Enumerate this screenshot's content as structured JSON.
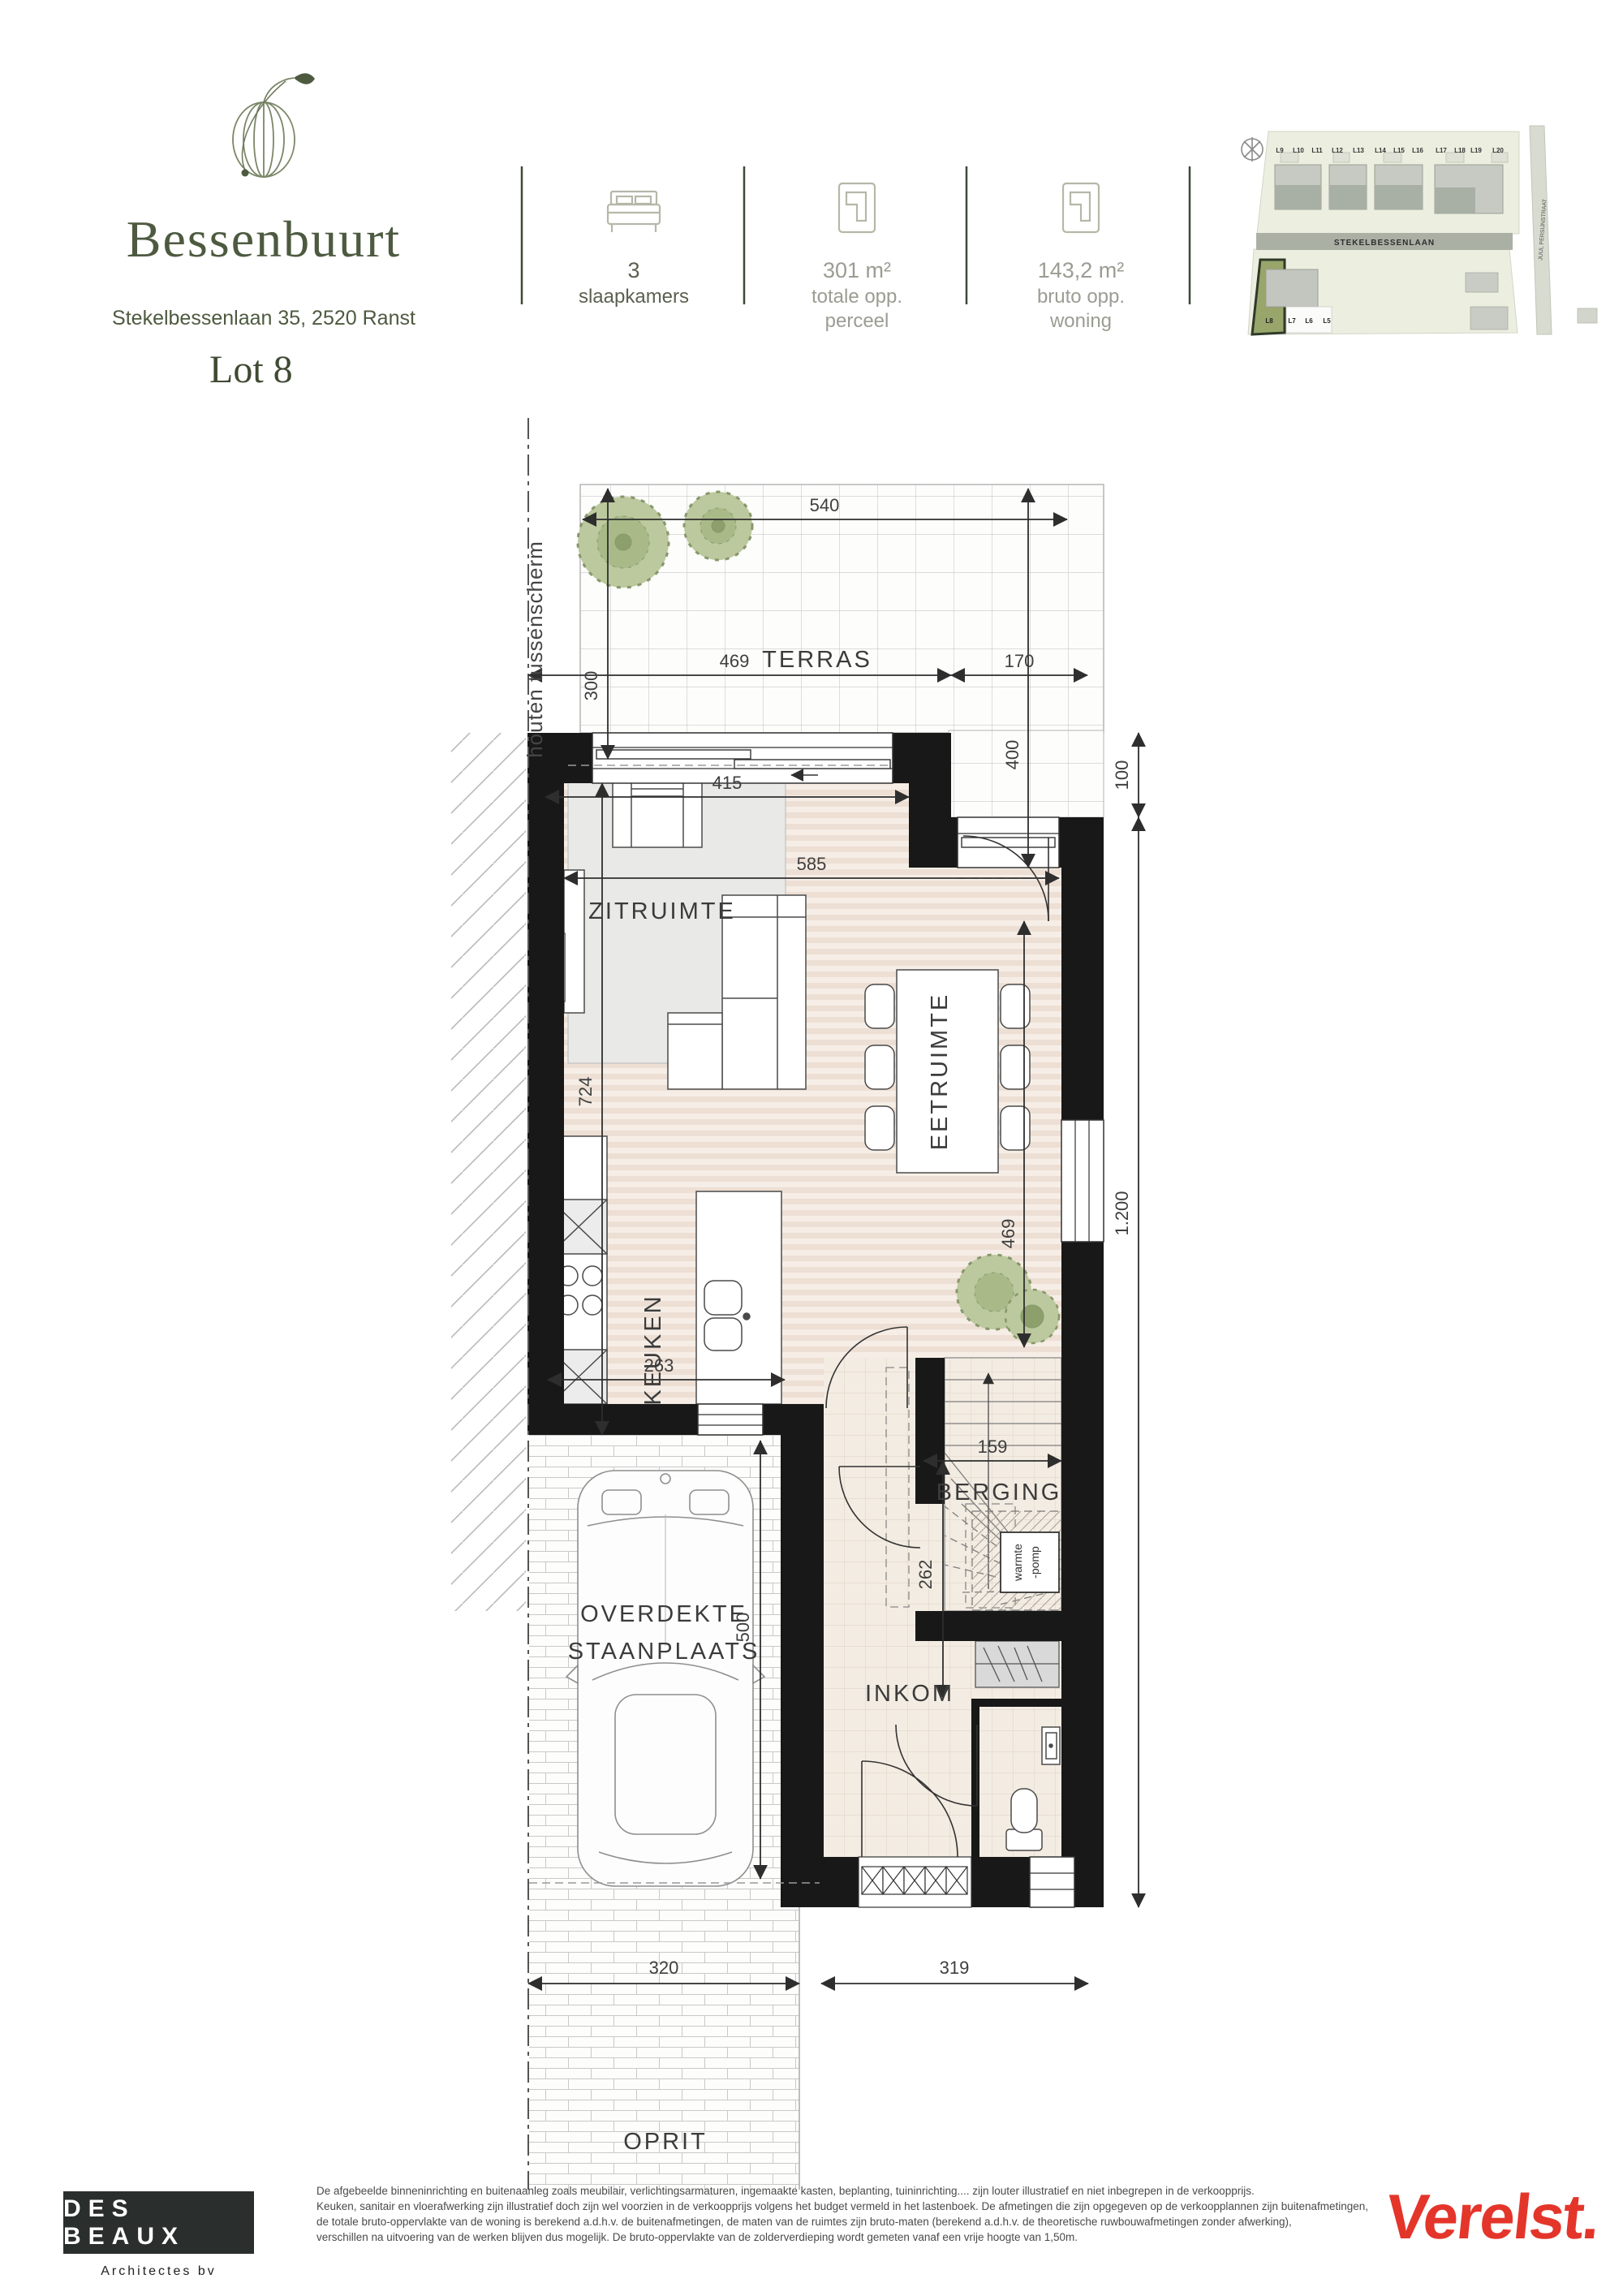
{
  "header": {
    "title": "Bessenbuurt",
    "address": "Stekelbessenlaan 35, 2520 Ranst",
    "stats": [
      {
        "value": "3",
        "label": "slaapkamers",
        "icon": "bed-icon"
      },
      {
        "value": "301 m²",
        "label": "totale opp. perceel",
        "icon": "floorplan-icon"
      },
      {
        "value": "143,2 m²",
        "label": "bruto opp. woning",
        "icon": "floorplan-icon"
      }
    ]
  },
  "lot_label": "Lot 8",
  "site_map": {
    "street_main": "STEKELBESSENLAAN",
    "street_side": "JUUL PERSIJNSTRAAT",
    "lots_top": [
      "L9",
      "L10",
      "L11",
      "L12",
      "L13",
      "L14",
      "L15",
      "L16",
      "L17",
      "L18",
      "L19",
      "L20"
    ],
    "lots_bottom": [
      "L8",
      "L7",
      "L6",
      "L5"
    ],
    "highlight_lot": "L8"
  },
  "plan": {
    "rooms": {
      "terras": "TERRAS",
      "zitruimte": "ZITRUIMTE",
      "eetruimte": "EETRUIMTE",
      "keuken": "KEUKEN",
      "berging": "BERGING",
      "inkom": "INKOM",
      "staanplaats_line1": "OVERDEKTE",
      "staanplaats_line2": "STAANPLAATS",
      "oprit": "OPRIT"
    },
    "annotations": {
      "boundary": "houten tussenscherm",
      "heatpump_line1": "warmte",
      "heatpump_line2": "-pomp"
    },
    "dims": {
      "terras_width": "540",
      "terras_depth": "300",
      "terras_depth_right": "400",
      "terras_bottom_left": "469",
      "terras_bottom_right": "170",
      "living_width_top": "415",
      "living_width": "585",
      "living_depth": "724",
      "dining_depth": "469",
      "kitchen_width": "263",
      "stair_width": "159",
      "stair_depth": "262",
      "parking_depth": "500",
      "parking_width": "320",
      "front_width": "319",
      "notch": "100",
      "house_depth_total": "1.200"
    }
  },
  "footer": {
    "architect_name": "DES BEAUX",
    "architect_sub": "Architectes bv",
    "developer": "Verelst.",
    "disclaimer_lines": [
      "De afgebeelde binneninrichting en buitenaanleg zoals meubilair, verlichtingsarmaturen, ingemaakte kasten, beplanting, tuininrichting.... zijn louter illustratief en niet inbegrepen in de verkoopprijs.",
      "Keuken, sanitair en vloerafwerking zijn illustratief doch zijn wel voorzien in de verkoopprijs volgens het budget vermeld in het lastenboek. De afmetingen die zijn opgegeven op de verkoopplannen zijn buitenafmetingen,",
      "de totale bruto-oppervlakte van de woning is berekend a.d.h.v. de buitenafmetingen, de maten van de ruimtes zijn bruto-maten (berekend a.d.h.v. de theoretische ruwbouwafmetingen zonder afwerking),",
      "verschillen na uitvoering van de werken blijven dus mogelijk. De bruto-oppervlakte van de zolderverdieping wordt gemeten vanaf een vrije hoogte van 1,50m."
    ]
  },
  "colors": {
    "brand_green": "#4d5a40",
    "wall": "#181818",
    "accent_red": "#e4352b",
    "highlight_lot": "#98a56b"
  }
}
